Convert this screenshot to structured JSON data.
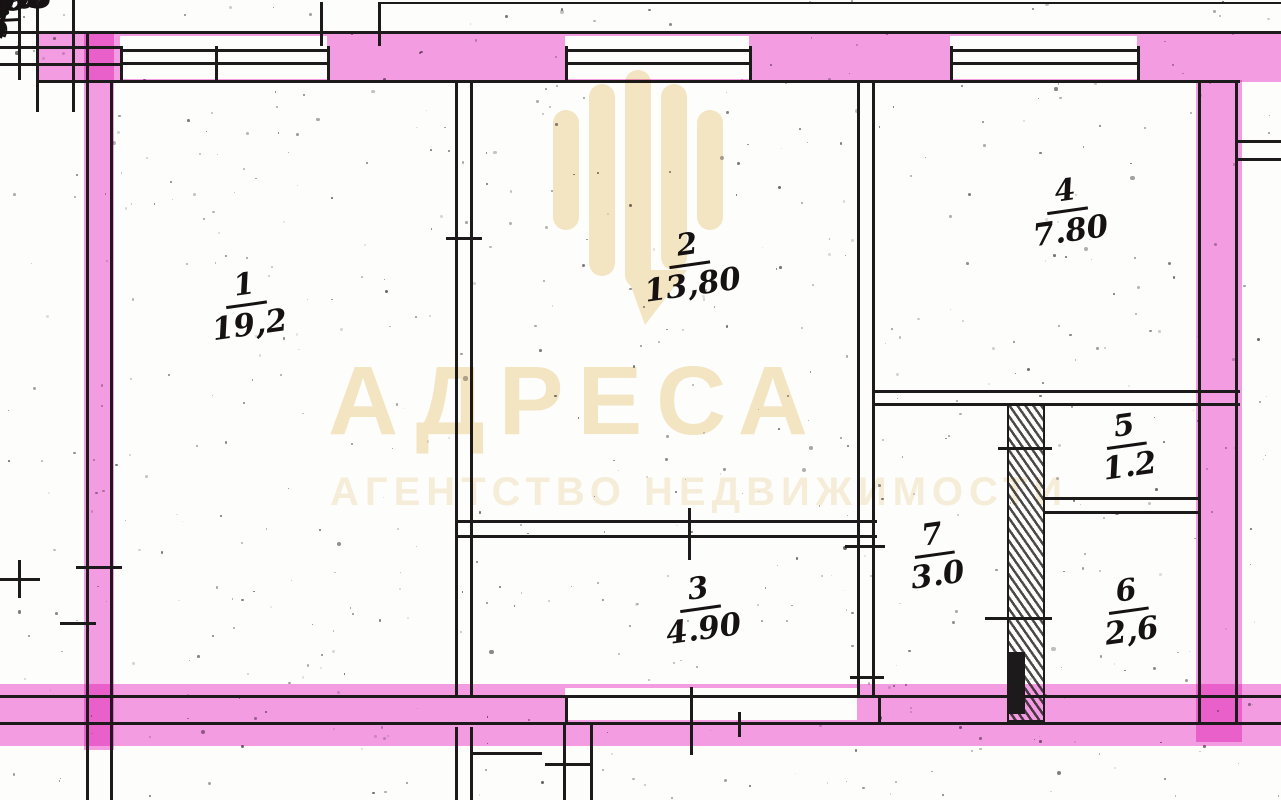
{
  "colors": {
    "ink": "#1d1a1b",
    "wall_highlight": "#f387e0",
    "watermark_title": "#f5e6c5",
    "watermark_subtitle": "#f8efdc"
  },
  "watermark": {
    "title": "АДРЕСА",
    "subtitle": "АГЕНТСТВО НЕДВИЖИМОСТИ",
    "icon": "map-pin-stripes"
  },
  "plan": {
    "apartment_label": "кв 38",
    "neighbor_label": "8",
    "rooms": [
      {
        "number": "1",
        "area": "19,2"
      },
      {
        "number": "2",
        "area": "13,80"
      },
      {
        "number": "3",
        "area": "4.90"
      },
      {
        "number": "4",
        "area": "7.80"
      },
      {
        "number": "5",
        "area": "1.2"
      },
      {
        "number": "6",
        "area": "2,6"
      },
      {
        "number": "7",
        "area": "3.0"
      }
    ],
    "dimensions": [
      {
        "id": "room1-top",
        "text": "3.47"
      },
      {
        "id": "room2-top",
        "text": "3.46"
      },
      {
        "id": "room4-top",
        "text": "2.80"
      },
      {
        "id": "left-wall",
        "text": "5.03"
      },
      {
        "id": "room2-left",
        "text": "4.0"
      },
      {
        "id": "room2-right",
        "text": "2.80"
      },
      {
        "id": "right-wall-top",
        "text": "2.45"
      },
      {
        "id": "hall-top",
        "text": "1.70"
      },
      {
        "id": "room5-right",
        "text": "0.80"
      },
      {
        "id": "right-wall-mid",
        "text": "0.84"
      },
      {
        "id": "hall-right",
        "text": "2.40"
      },
      {
        "id": "room3-top",
        "text": "3.47"
      },
      {
        "id": "room3-left",
        "text": "1.40"
      },
      {
        "id": "room6-right",
        "text": "1.40"
      },
      {
        "id": "right-wall-bottom",
        "text": "1.40"
      },
      {
        "id": "room6-bottom",
        "text": "1.50"
      },
      {
        "id": "bottom-left",
        "text": "4.50"
      },
      {
        "id": "bottom-right",
        "text": "10.98"
      },
      {
        "id": "bottom-corner",
        "text": "1.10"
      },
      {
        "id": "bottom-fragment",
        "text": "30"
      }
    ]
  }
}
